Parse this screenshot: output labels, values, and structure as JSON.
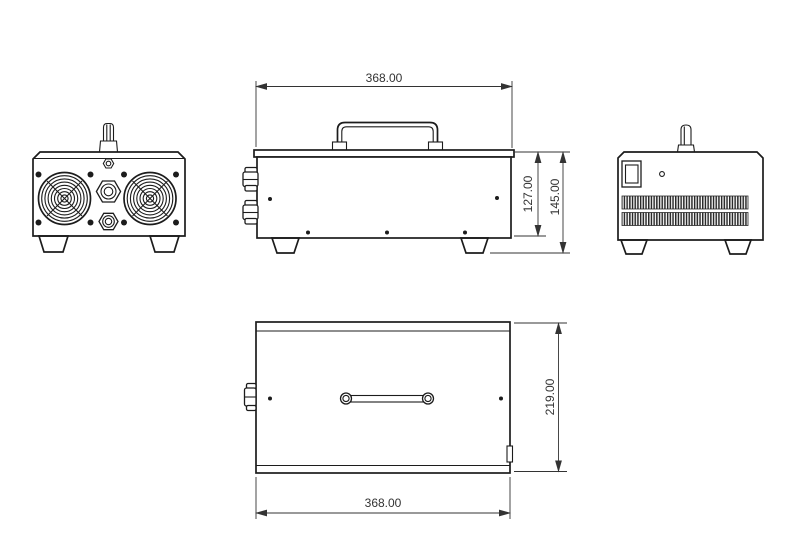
{
  "dimensions": {
    "side_width": "368.00",
    "body_height": "127.00",
    "overall_height": "145.00",
    "depth": "219.00",
    "bottom_width": "368.00"
  },
  "colors": {
    "background": "#ffffff",
    "line_color": "#1c1c1c",
    "dim_color": "#333333"
  }
}
